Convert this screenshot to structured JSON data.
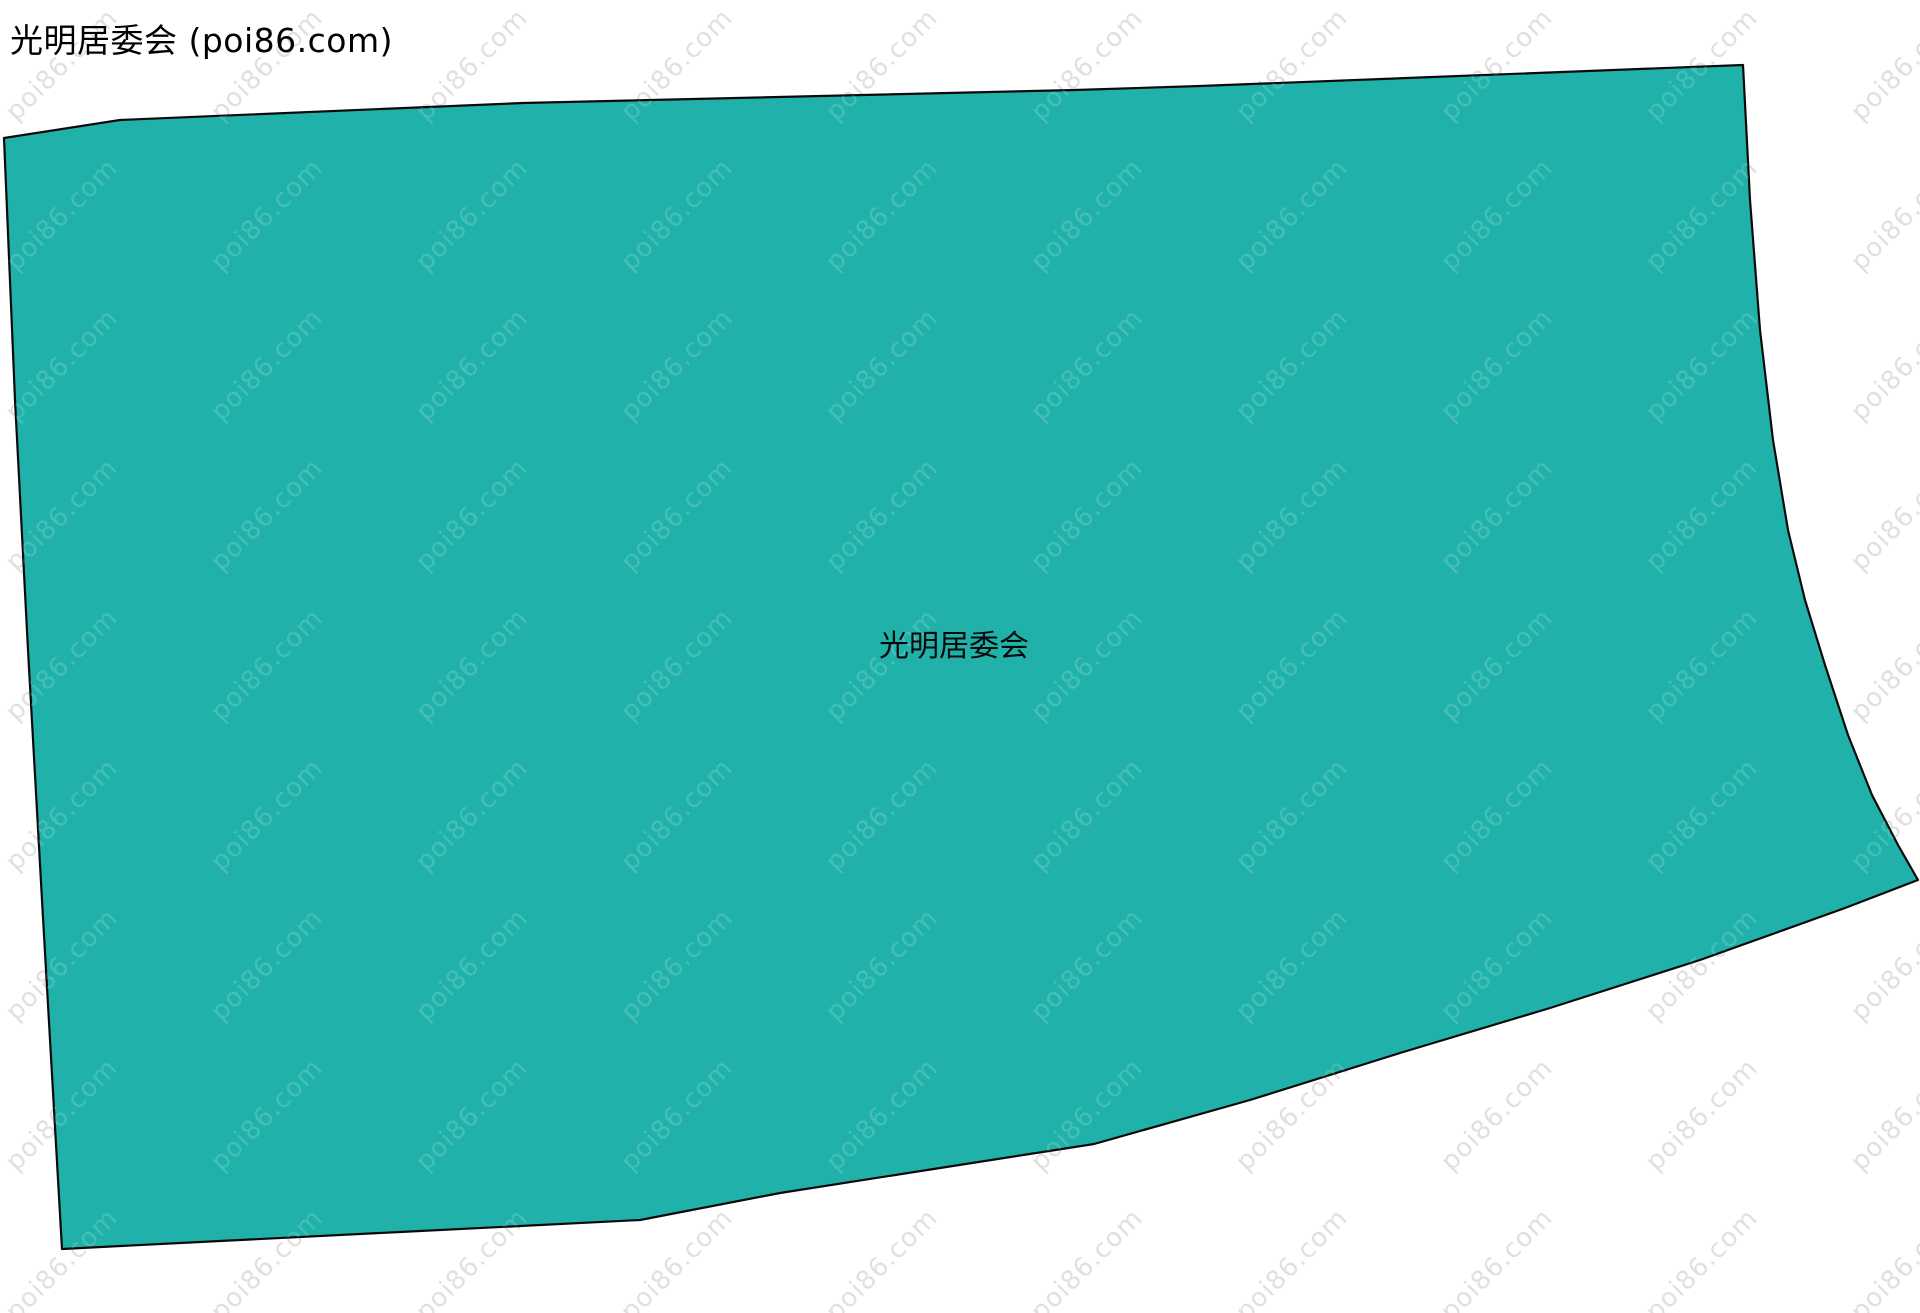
{
  "page_title": "光明居委会 (poi86.com)",
  "map": {
    "region_label": "光明居委会",
    "fill_color": "#20b2aa",
    "stroke_color": "#0a0a0a",
    "stroke_width": "2.2",
    "polygon_points": [
      [
        4,
        138
      ],
      [
        120,
        120
      ],
      [
        523,
        103
      ],
      [
        1075,
        90
      ],
      [
        1200,
        86
      ],
      [
        1743,
        65
      ],
      [
        1750,
        200
      ],
      [
        1760,
        330
      ],
      [
        1773,
        440
      ],
      [
        1788,
        530
      ],
      [
        1805,
        600
      ],
      [
        1825,
        665
      ],
      [
        1848,
        735
      ],
      [
        1872,
        795
      ],
      [
        1898,
        845
      ],
      [
        1918,
        880
      ],
      [
        1845,
        908
      ],
      [
        1700,
        960
      ],
      [
        1550,
        1008
      ],
      [
        1400,
        1053
      ],
      [
        1250,
        1100
      ],
      [
        1094,
        1144
      ],
      [
        940,
        1168
      ],
      [
        780,
        1193
      ],
      [
        640,
        1220
      ],
      [
        400,
        1232
      ],
      [
        200,
        1242
      ],
      [
        62,
        1249
      ],
      [
        42,
        900
      ],
      [
        28,
        650
      ],
      [
        15,
        400
      ]
    ]
  },
  "watermark": {
    "text": "poi86.com",
    "color_on_white": "rgba(0,0,0,0.12)",
    "color_on_region": "rgba(255,255,255,0.16)",
    "angle_deg": -45,
    "spacing_x": 205,
    "spacing_y": 150
  }
}
